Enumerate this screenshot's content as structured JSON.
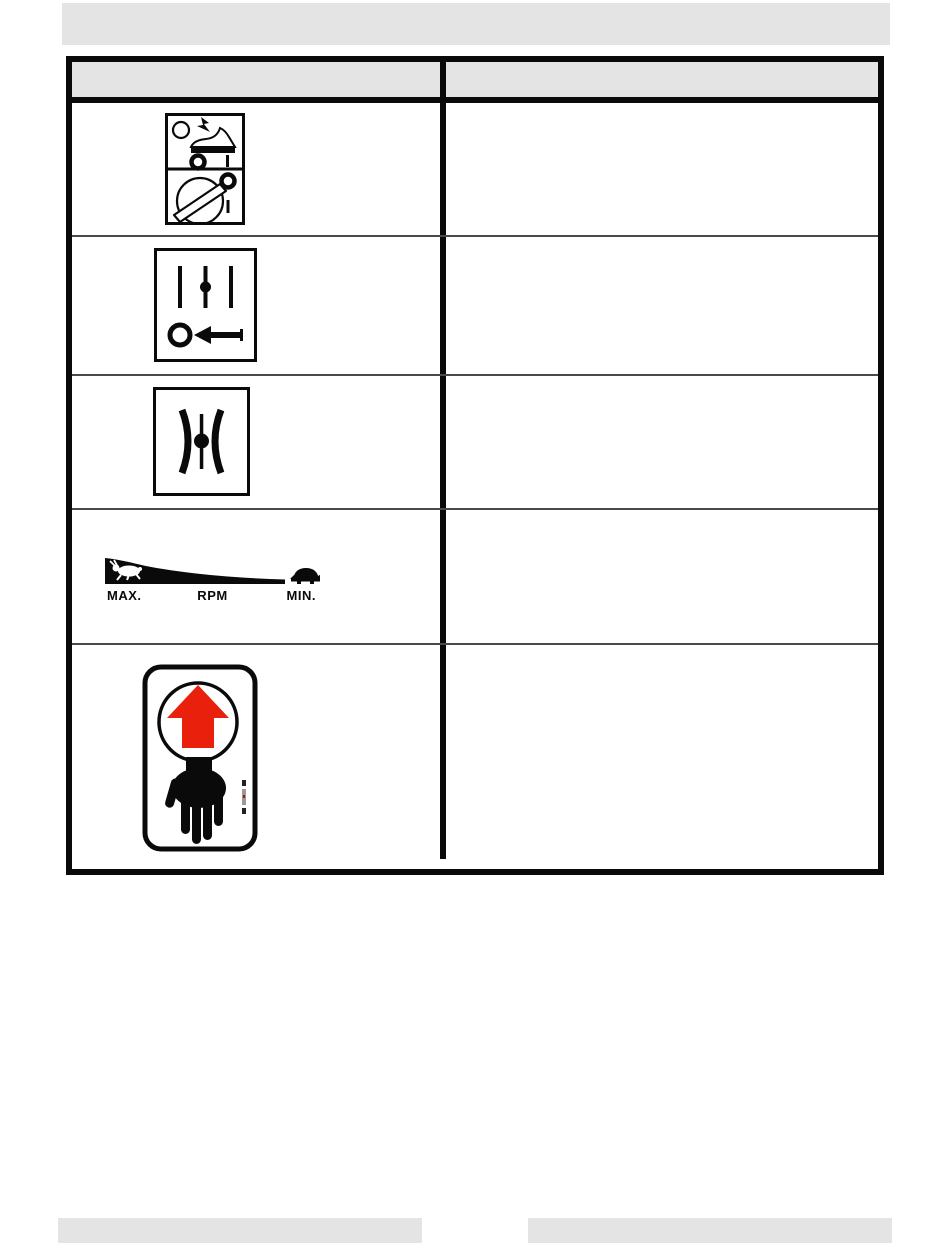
{
  "page": {
    "kind": "scanned-manual-symbols-table-page",
    "background": "#ffffff",
    "redaction_bar_color": "#e4e4e4"
  },
  "table": {
    "header": {
      "fill": "#e4e4e4",
      "symbol_column_label": "",
      "description_column_label": ""
    },
    "rows": [
      {
        "icon": "engine-switch-key-symbol",
        "description": ""
      },
      {
        "icon": "primer-press-symbol",
        "description": ""
      },
      {
        "icon": "choke-symbol",
        "description": ""
      },
      {
        "icon": "throttle-fast-slow-symbol",
        "description": "",
        "labels": {
          "max": "MAX.",
          "rpm": "RPM",
          "min": "MIN."
        }
      },
      {
        "icon": "keep-hands-away-warning-label",
        "description": ""
      }
    ]
  },
  "colors": {
    "line_black": "#0a0a0a",
    "gray_fill": "#e4e4e4",
    "warning_red": "#e8200c"
  }
}
